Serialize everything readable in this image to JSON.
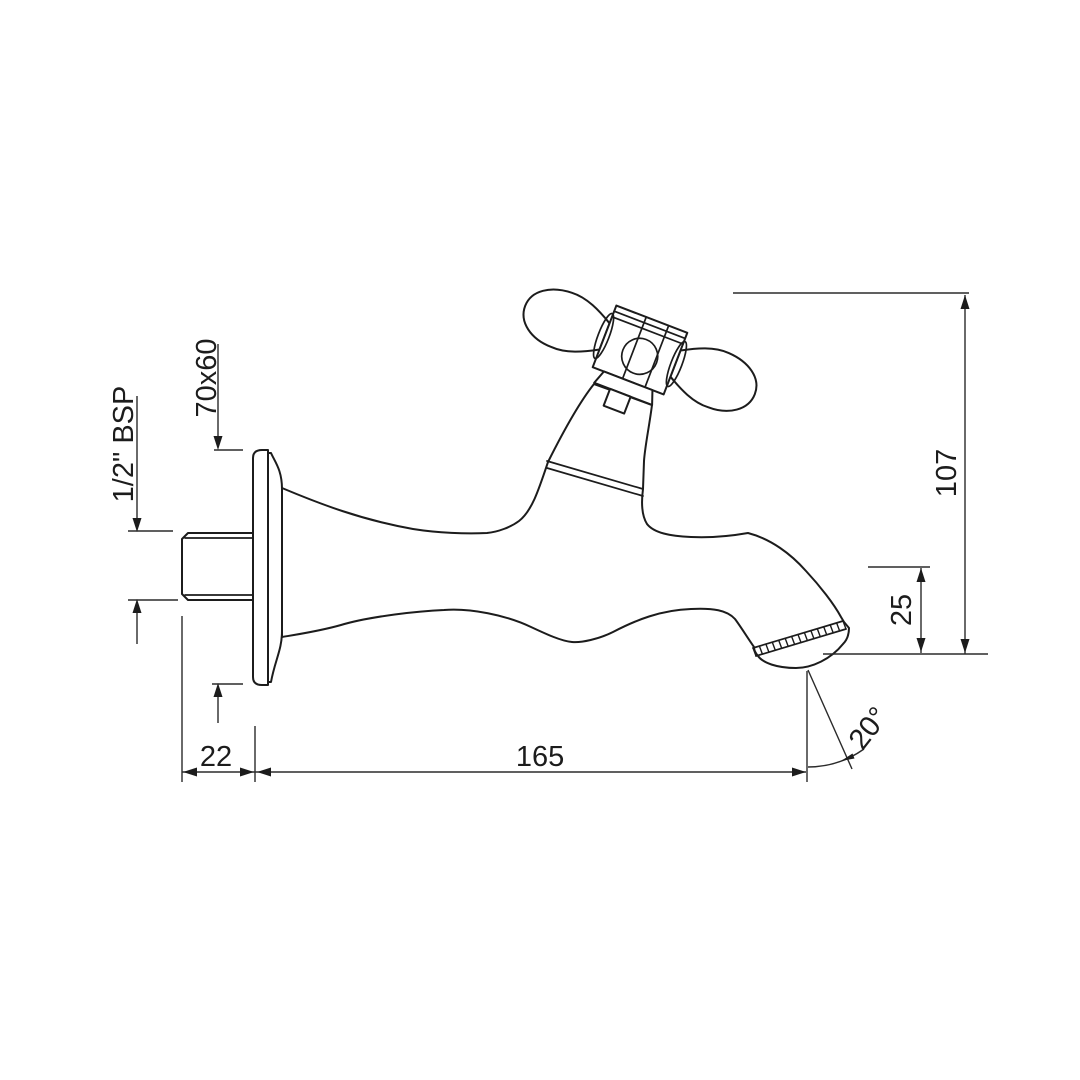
{
  "drawing": {
    "background": "#ffffff",
    "line_color": "#1c1c1c",
    "dimension_line_color": "#2b2b2b",
    "dimensions": {
      "flange_size": "70x60",
      "inlet_thread": "1/2\" BSP",
      "overall_height": "107",
      "spout_clearance": "25",
      "wall_projection": "22",
      "spout_reach": "165",
      "outlet_angle": "20°"
    }
  }
}
